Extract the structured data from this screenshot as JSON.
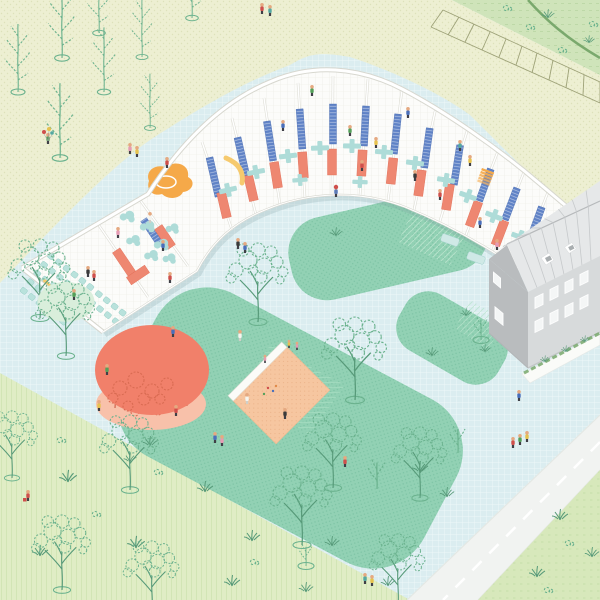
{
  "scene": {
    "description": "Axonometric architectural site illustration: a curved single-storey school building shown in open-roof cutaway with classrooms, an auditorium, blue and salmon partition panels and teal furniture; a light-blue gridded courtyard with rounded teal lawns, a sandbox, a round orange play canopy, sketchy trees, an adjacent gray two-storey house, a parking strip, fields and a road with tiny people throughout."
  },
  "palette": {
    "fieldYellow": "#edefd2",
    "fieldYellowDot": "#dde1ba",
    "fieldGreenTR": "#cfe4ba",
    "fieldGreenTRDash": "#b9d6a2",
    "fieldGreenBL": "#e0edc5",
    "fieldGreenBLStripe": "#c8dfa8",
    "fieldGreenBR": "#d7e8bb",
    "fieldGreenBRDash": "#c2dca6",
    "courtBlue": "#dbedf0",
    "courtGrid": "#eef8f9",
    "lawn": "#92d1b4",
    "lawnDot": "#7cc3a4",
    "lawnHatch": "#b8e3cc",
    "lawnStripe": "#a5dcc0",
    "treeLine": "#6bb28e",
    "treeDark": "#579a79",
    "treeFillLight": "#d9eedb",
    "road": "#f1f3f1",
    "roadEdge": "#e4e8e4",
    "parkLine": "#8f9468",
    "hedge": "#7aa96d",
    "bldgFloor": "#fcfcfa",
    "bldgWall": "#ffffff",
    "bldgWallEdge": "#d7d7cf",
    "bldgGrid": "#ebebe3",
    "salmon": "#ee8771",
    "salmonDark": "#e06b54",
    "panelBlue": "#5f82c6",
    "furnTeal": "#aedcd8",
    "chairTeal": "#b9e2dc",
    "bedTeal": "#cfe9e6",
    "playOrange": "#f5a949",
    "benchYellow": "#f6ca6e",
    "sand": "#f6c6a0",
    "sandDot": "#e9ad82",
    "sandEdge": "#f0ba90",
    "circleOrange": "#f1806a",
    "circlePeach": "#f8c1aa",
    "circleTree": "#d96b52",
    "houseWall": "#d7dadb",
    "houseGable": "#b9bcbe",
    "houseRoof": "#e6e8e9",
    "houseSeam": "#c6c9cb",
    "houseWin": "#f4f6f6",
    "skinTone": "#e5a981",
    "legDark": "#3f3f46",
    "personRed": "#cf4f4b",
    "personBlue": "#4a6fba",
    "personGreen": "#55a05a",
    "personYellow": "#e6c24f",
    "personPink": "#e59bb4",
    "personBlack": "#3b3b3b",
    "personTeal": "#54a8a2",
    "personOrange": "#e08a4a",
    "personWhite": "#f5f5ef"
  },
  "inventory": {
    "people": 48,
    "large_trees": 12,
    "young_saplings": 8,
    "small_saplings": 4,
    "lawns": 3,
    "buildings": 2,
    "playground_items": [
      "sandbox",
      "round-canopy",
      "indoor-slide",
      "benches",
      "auditorium-chairs"
    ]
  }
}
